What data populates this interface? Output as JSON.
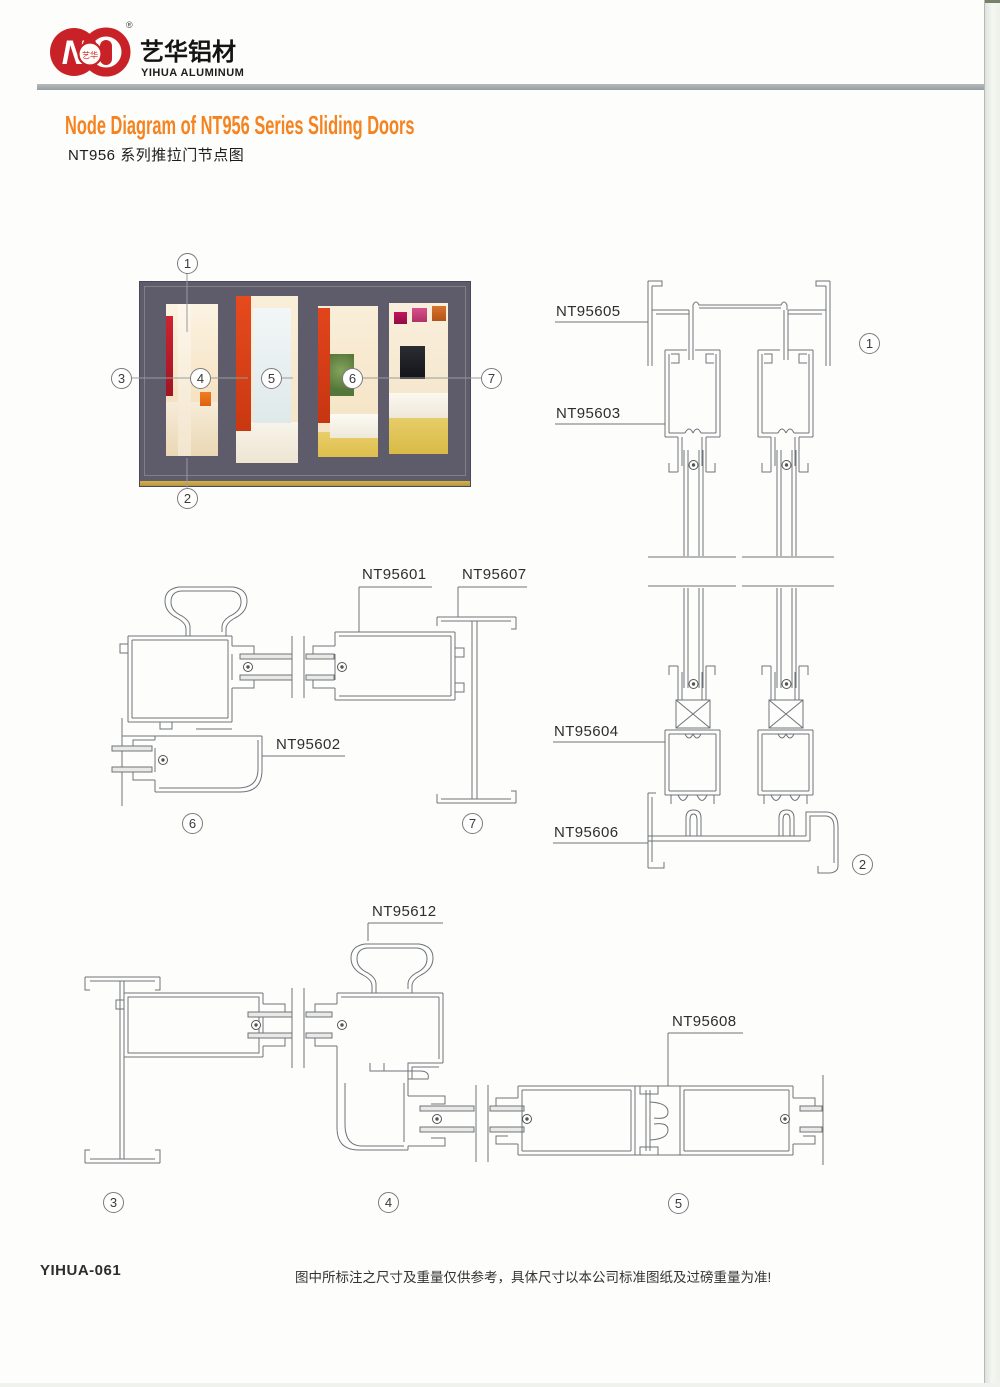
{
  "brand": {
    "logo_cn": "艺华铝材",
    "logo_en": "YIHUA ALUMINUM",
    "registered": "®",
    "badge_cn": "艺华",
    "emblem_letter": "N"
  },
  "heading": {
    "title_en": "Node Diagram of NT956 Series Sliding Doors",
    "title_cn": "NT956 系列推拉门节点图"
  },
  "photo": {
    "callouts": [
      "1",
      "2",
      "3",
      "4",
      "5",
      "6",
      "7"
    ]
  },
  "diagram": {
    "part_labels": {
      "nt95605": "NT95605",
      "nt95603": "NT95603",
      "nt95604": "NT95604",
      "nt95606": "NT95606",
      "nt95601": "NT95601",
      "nt95607": "NT95607",
      "nt95602": "NT95602",
      "nt95612": "NT95612",
      "nt95608": "NT95608"
    },
    "detail_markers": {
      "d1": "1",
      "d2": "2",
      "d3": "3",
      "d4": "4",
      "d5": "5",
      "d6": "6",
      "d7": "7"
    }
  },
  "footer": {
    "code": "YIHUA-061",
    "disclaimer": "图中所标注之尺寸及重量仅供参考，具体尺寸以本公司标准图纸及过磅重量为准!"
  },
  "colors": {
    "accent_orange": "#f5831f",
    "logo_red": "#c82127",
    "divider_gray": "#a9adb0",
    "cad_line": "#6e737a",
    "door_frame": "#5e5b6a"
  }
}
